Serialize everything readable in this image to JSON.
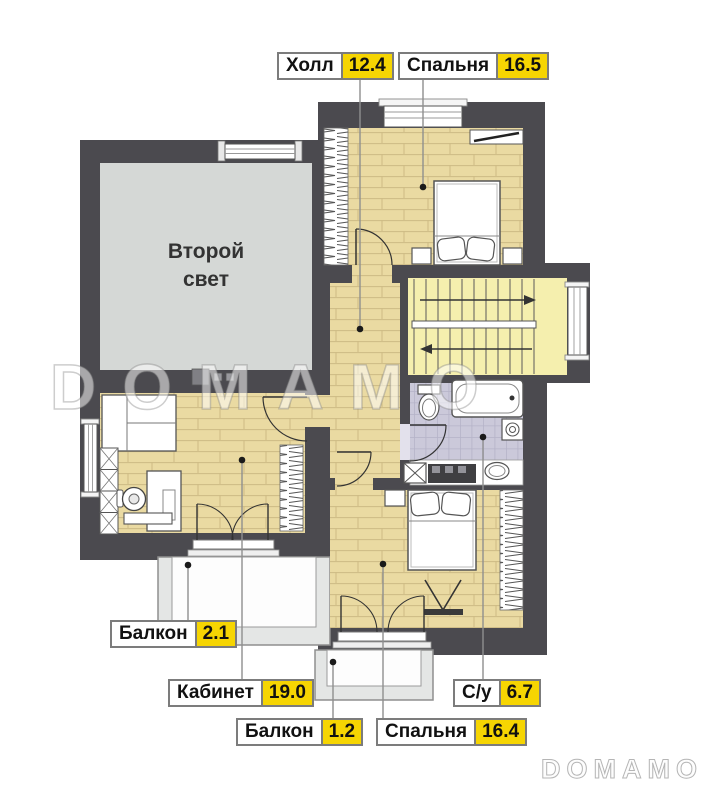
{
  "page": {
    "watermark": "DOMAMO",
    "logo": "DOMAMO"
  },
  "rooms": {
    "second_light_line1": "Второй",
    "second_light_line2": "свет"
  },
  "labels": {
    "hall": {
      "name": "Холл",
      "area": "12.4"
    },
    "bedroom_top": {
      "name": "Спальня",
      "area": "16.5"
    },
    "balcony_left": {
      "name": "Балкон",
      "area": "2.1"
    },
    "office": {
      "name": "Кабинет",
      "area": "19.0"
    },
    "su": {
      "name": "С/у",
      "area": "6.7"
    },
    "balcony_small": {
      "name": "Балкон",
      "area": "1.2"
    },
    "bedroom_bottom": {
      "name": "Спальня",
      "area": "16.4"
    }
  },
  "colors": {
    "wall": "#4b4a4f",
    "wood": "#eadaa2",
    "stairs": "#f5efae",
    "tile": "#cbc9da",
    "second_light": "#d5d8d6",
    "accent": "#f6d502"
  }
}
